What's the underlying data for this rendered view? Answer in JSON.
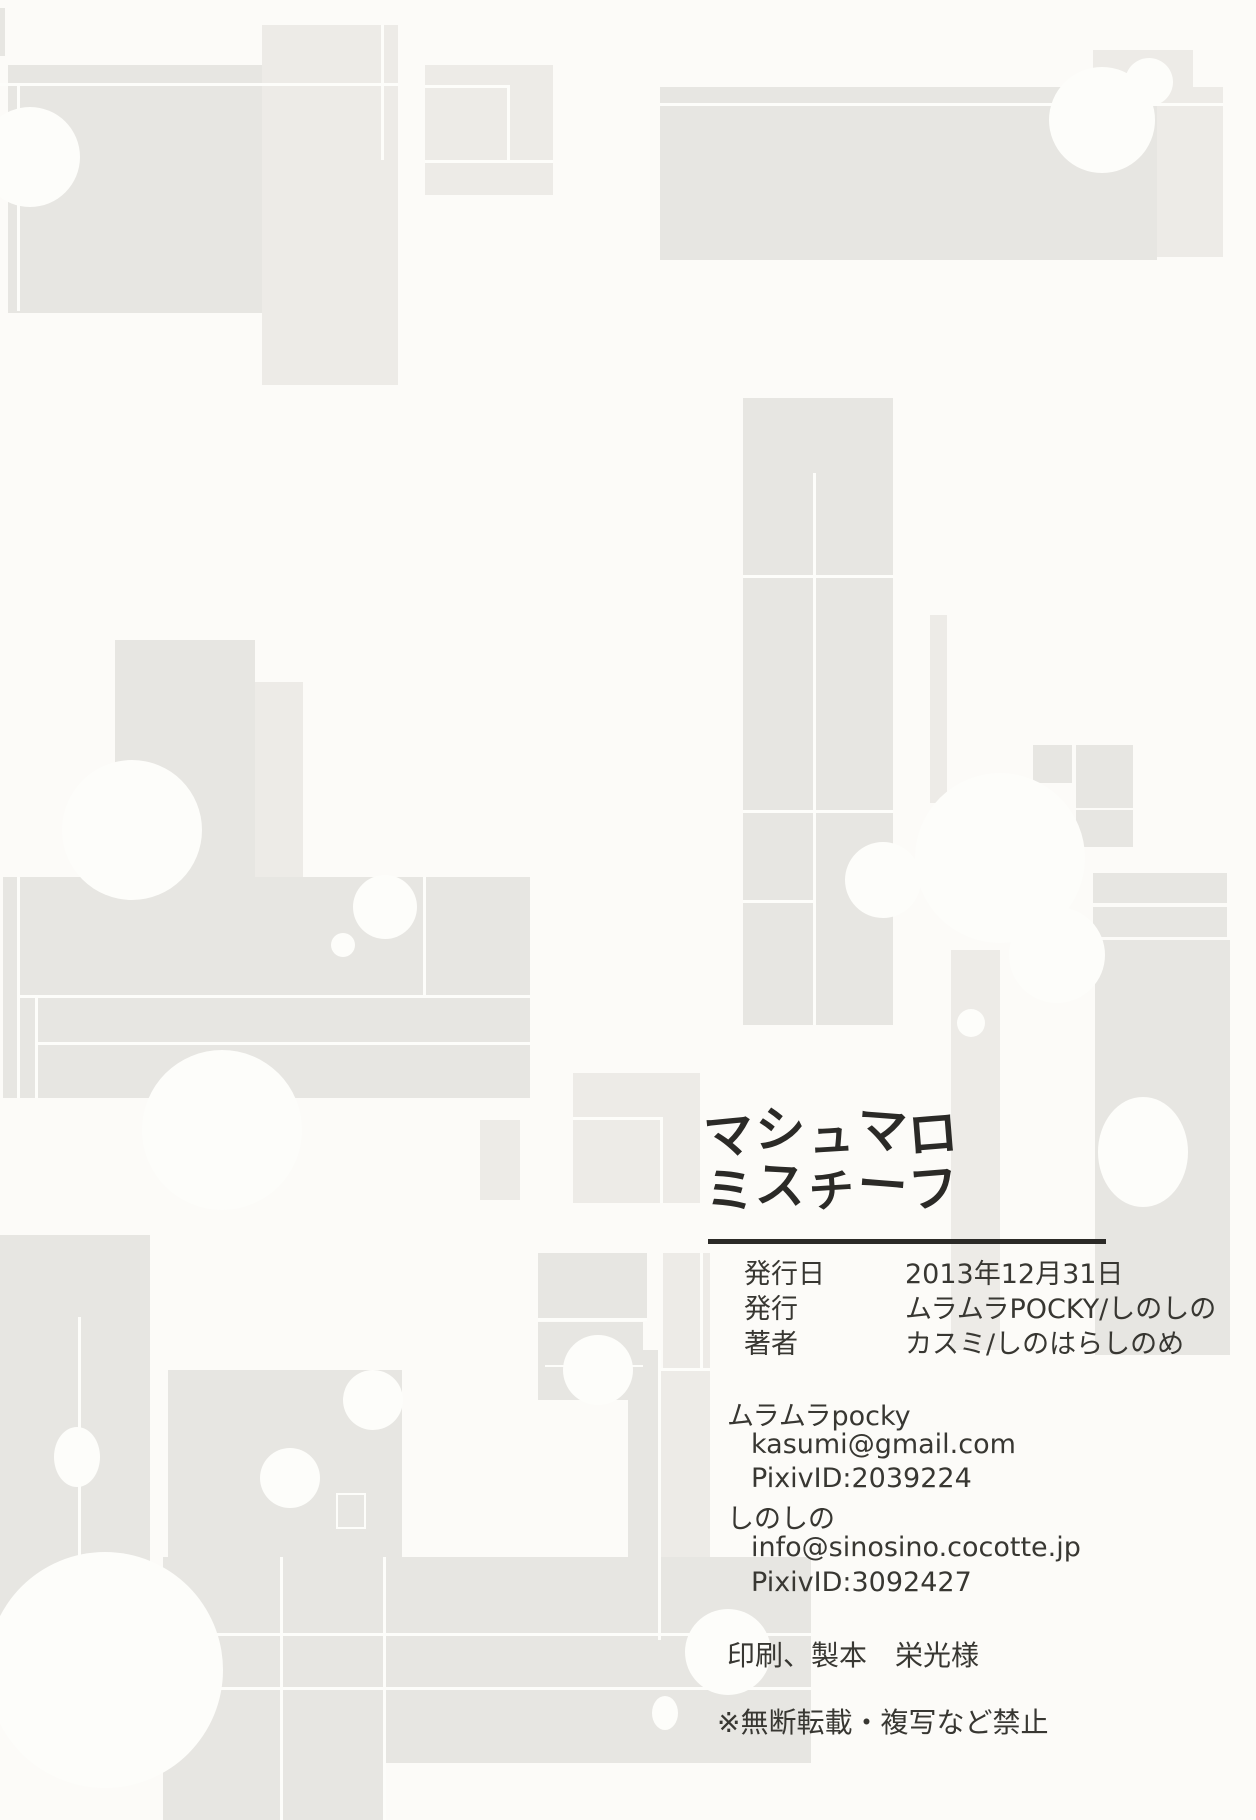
{
  "page": {
    "logo": {
      "line1": "マシュマロ",
      "line2": "ミスチーフ"
    },
    "colophon": {
      "rows": [
        {
          "label": "発行日",
          "value": "2013年12月31日"
        },
        {
          "label": "発行",
          "value": "ムラムラPOCKY/しのしの"
        },
        {
          "label": "著者",
          "value": "カスミ/しのはらしのめ"
        }
      ],
      "contacts": [
        {
          "name": "ムラムラpocky",
          "email": "kasumi@gmail.com",
          "pixiv": "PixivID:2039224"
        },
        {
          "name": "しのしの",
          "email": "info@sinosino.cocotte.jp",
          "pixiv": "PixivID:3092427"
        }
      ],
      "printing": {
        "label": "印刷、製本",
        "value": "栄光様"
      },
      "notice": "※無断転載・複写など禁止"
    }
  },
  "colors": {
    "background": "#fcfbf8",
    "shape_gray": "#e7e6e2",
    "shape_gray_light": "#edebe7",
    "shape_gray_dark": "#e3e2de",
    "cutout_white": "#fdfdfa",
    "ink": "#383732"
  }
}
